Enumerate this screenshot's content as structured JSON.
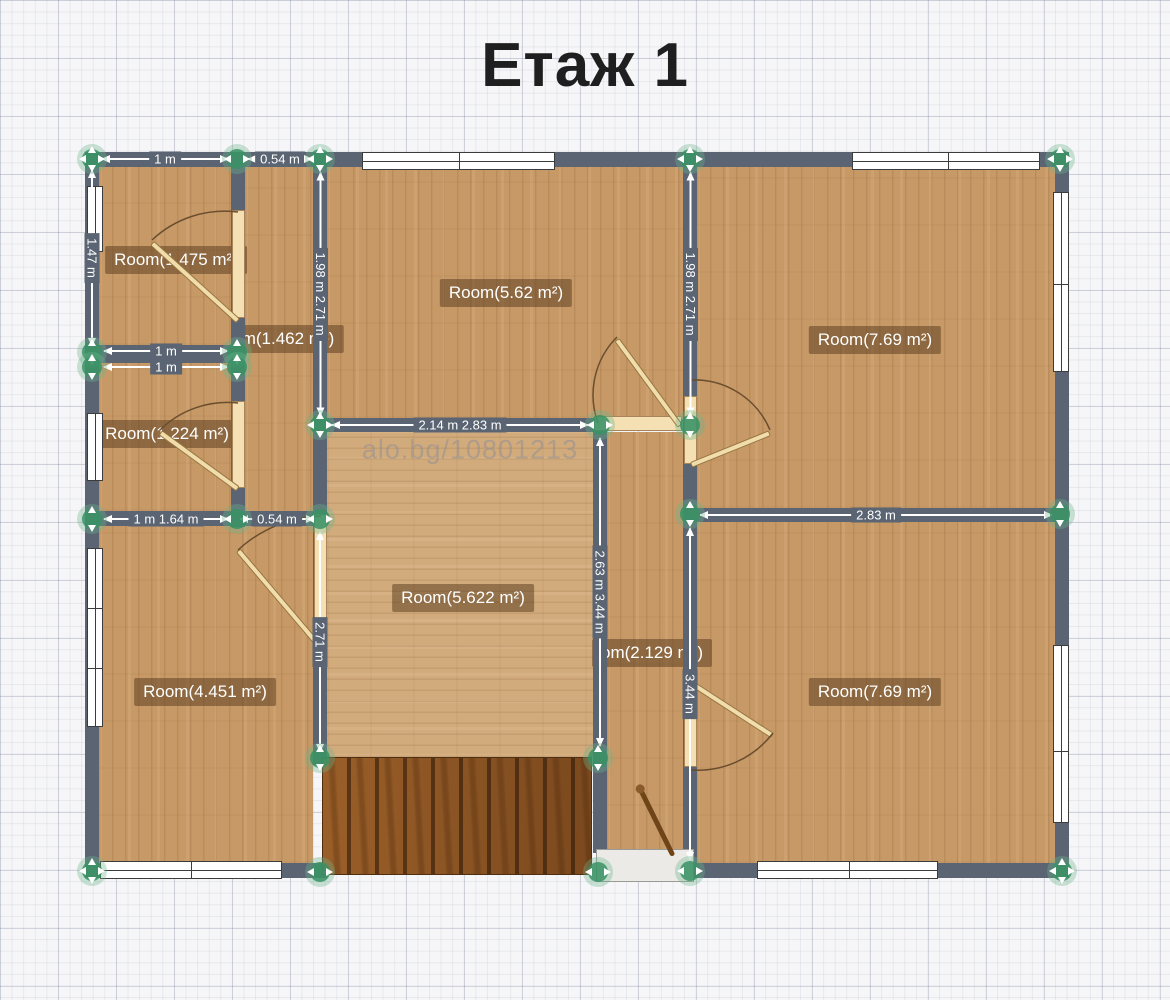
{
  "title": "Етаж 1",
  "watermark": {
    "text": "alo.bg/10801213",
    "cx": 470,
    "cy": 450
  },
  "colors": {
    "wall": "#5a6472",
    "handle_green": "#389265",
    "wood_light": "#c79967",
    "wood_center": "#d2ab7d",
    "stairs_brown": "#8c5322",
    "door_beige": "#f4e0b2",
    "label_bg": "rgba(90,60,28,0.52)",
    "grid_bg": "#f6f6f8"
  },
  "floors": [
    {
      "id": "room-1475-floor",
      "x": 99,
      "y": 167,
      "w": 132,
      "h": 178,
      "grain": "v"
    },
    {
      "id": "room-1462-floor",
      "x": 245,
      "y": 167,
      "w": 68,
      "h": 351,
      "grain": "v"
    },
    {
      "id": "room-1224-floor",
      "x": 99,
      "y": 363,
      "w": 132,
      "h": 148,
      "grain": "v"
    },
    {
      "id": "room-562-floor",
      "x": 327,
      "y": 167,
      "w": 356,
      "h": 251,
      "grain": "v"
    },
    {
      "id": "room-769-top-floor",
      "x": 697,
      "y": 167,
      "w": 358,
      "h": 341,
      "grain": "v"
    },
    {
      "id": "room-5622-floor",
      "x": 327,
      "y": 432,
      "w": 266,
      "h": 325,
      "grain": "h"
    },
    {
      "id": "hallway-floor",
      "x": 607,
      "y": 432,
      "w": 76,
      "h": 421,
      "grain": "v"
    },
    {
      "id": "room-4451-floor",
      "x": 99,
      "y": 526,
      "w": 214,
      "h": 337,
      "grain": "v"
    },
    {
      "id": "room-769-bottom-floor",
      "x": 697,
      "y": 522,
      "w": 358,
      "h": 341,
      "grain": "v"
    }
  ],
  "room_labels": [
    {
      "id": "room-1475-label",
      "text": "Room(1.475 m²)",
      "cx": 176,
      "cy": 260
    },
    {
      "id": "room-1462-label",
      "text": "m(1.462 m²)",
      "cx": 288,
      "cy": 339
    },
    {
      "id": "room-562-label",
      "text": "Room(5.62 m²)",
      "cx": 506,
      "cy": 293
    },
    {
      "id": "room-769-top-label",
      "text": "Room(7.69 m²)",
      "cx": 875,
      "cy": 340
    },
    {
      "id": "room-1224-label",
      "text": "Room(1.224 m²)",
      "cx": 167,
      "cy": 434
    },
    {
      "id": "room-5622-label",
      "text": "Room(5.622 m²)",
      "cx": 463,
      "cy": 598
    },
    {
      "id": "hallway-label",
      "text": "om(2.129 m²)",
      "cx": 652,
      "cy": 653
    },
    {
      "id": "room-4451-label",
      "text": "Room(4.451 m²)",
      "cx": 205,
      "cy": 692
    },
    {
      "id": "room-769-bottom-label",
      "text": "Room(7.69 m²)",
      "cx": 875,
      "cy": 692
    }
  ],
  "walls": [
    {
      "x": 85,
      "y": 152,
      "w": 984,
      "h": 15
    },
    {
      "x": 85,
      "y": 152,
      "w": 14,
      "h": 726
    },
    {
      "x": 1055,
      "y": 152,
      "w": 14,
      "h": 726
    },
    {
      "x": 85,
      "y": 863,
      "w": 242,
      "h": 15
    },
    {
      "x": 683,
      "y": 863,
      "w": 386,
      "h": 15
    },
    {
      "x": 231,
      "y": 152,
      "w": 14,
      "h": 375
    },
    {
      "x": 313,
      "y": 152,
      "w": 14,
      "h": 613
    },
    {
      "x": 593,
      "y": 425,
      "w": 14,
      "h": 428
    },
    {
      "x": 683,
      "y": 152,
      "w": 14,
      "h": 711
    },
    {
      "x": 85,
      "y": 345,
      "w": 160,
      "h": 18
    },
    {
      "x": 85,
      "y": 511,
      "w": 242,
      "h": 15
    },
    {
      "x": 313,
      "y": 418,
      "w": 294,
      "h": 14
    },
    {
      "x": 683,
      "y": 508,
      "w": 386,
      "h": 14
    }
  ],
  "windows": [
    {
      "x": 362,
      "y": 152,
      "w": 193,
      "h": 18,
      "o": "h",
      "divs": [
        96
      ]
    },
    {
      "x": 852,
      "y": 152,
      "w": 188,
      "h": 18,
      "o": "h",
      "divs": [
        95
      ]
    },
    {
      "x": 87,
      "y": 186,
      "w": 16,
      "h": 66,
      "o": "v",
      "divs": []
    },
    {
      "x": 87,
      "y": 413,
      "w": 16,
      "h": 68,
      "o": "v",
      "divs": []
    },
    {
      "x": 87,
      "y": 548,
      "w": 16,
      "h": 179,
      "o": "v",
      "divs": [
        59,
        119
      ]
    },
    {
      "x": 100,
      "y": 861,
      "w": 182,
      "h": 18,
      "o": "h",
      "divs": [
        90
      ]
    },
    {
      "x": 757,
      "y": 861,
      "w": 181,
      "h": 18,
      "o": "h",
      "divs": [
        91
      ]
    },
    {
      "x": 1053,
      "y": 192,
      "w": 16,
      "h": 180,
      "o": "v",
      "divs": [
        91
      ]
    },
    {
      "x": 1053,
      "y": 645,
      "w": 16,
      "h": 178,
      "o": "v",
      "divs": [
        105
      ]
    }
  ],
  "dimensions": [
    {
      "label": "1 m",
      "o": "h",
      "x": 102,
      "y": 159,
      "len": 126
    },
    {
      "label": "0.54 m",
      "o": "h",
      "x": 248,
      "y": 159,
      "len": 64
    },
    {
      "label": "1 m",
      "o": "h",
      "x": 104,
      "y": 351,
      "len": 124
    },
    {
      "label": "1 m",
      "o": "h",
      "x": 104,
      "y": 367,
      "len": 124
    },
    {
      "label": "1 m  1.64 m",
      "o": "h",
      "x": 104,
      "y": 519,
      "len": 124
    },
    {
      "label": "0.54 m",
      "o": "h",
      "x": 240,
      "y": 519,
      "len": 74
    },
    {
      "label": "2.14 m 2.83 m",
      "o": "h",
      "x": 332,
      "y": 425,
      "len": 256
    },
    {
      "label": "2.83 m",
      "o": "h",
      "x": 700,
      "y": 515,
      "len": 352
    },
    {
      "label": "1.47 m",
      "o": "v",
      "x": 92,
      "y": 170,
      "len": 176
    },
    {
      "label": "1.98 m 2.71 m",
      "o": "v",
      "x": 320,
      "y": 172,
      "len": 243
    },
    {
      "label": "1.98 m 2.71 m",
      "o": "v",
      "x": 690,
      "y": 172,
      "len": 243
    },
    {
      "label": "2.71 m",
      "o": "v",
      "x": 320,
      "y": 532,
      "len": 220
    },
    {
      "label": "2.63 m 3.44 m",
      "o": "v",
      "x": 600,
      "y": 438,
      "len": 308
    },
    {
      "label": "3.44 m",
      "o": "v",
      "x": 690,
      "y": 528,
      "len": 332
    }
  ],
  "handles": [
    {
      "x": 92,
      "y": 159,
      "dir": "hv"
    },
    {
      "x": 237,
      "y": 159,
      "dir": "h"
    },
    {
      "x": 320,
      "y": 159,
      "dir": "hv"
    },
    {
      "x": 690,
      "y": 159,
      "dir": "hv"
    },
    {
      "x": 1060,
      "y": 159,
      "dir": "hv"
    },
    {
      "x": 92,
      "y": 352,
      "dir": "v"
    },
    {
      "x": 92,
      "y": 367,
      "dir": "v"
    },
    {
      "x": 92,
      "y": 519,
      "dir": "v"
    },
    {
      "x": 92,
      "y": 871,
      "dir": "hv"
    },
    {
      "x": 237,
      "y": 352,
      "dir": "v"
    },
    {
      "x": 237,
      "y": 367,
      "dir": "v"
    },
    {
      "x": 237,
      "y": 519,
      "dir": "h"
    },
    {
      "x": 320,
      "y": 425,
      "dir": "hv"
    },
    {
      "x": 320,
      "y": 519,
      "dir": "h"
    },
    {
      "x": 320,
      "y": 758,
      "dir": "v"
    },
    {
      "x": 320,
      "y": 872,
      "dir": "h"
    },
    {
      "x": 600,
      "y": 425,
      "dir": "h"
    },
    {
      "x": 598,
      "y": 758,
      "dir": "v"
    },
    {
      "x": 598,
      "y": 872,
      "dir": "h"
    },
    {
      "x": 690,
      "y": 425,
      "dir": "v"
    },
    {
      "x": 690,
      "y": 514,
      "dir": "v"
    },
    {
      "x": 690,
      "y": 871,
      "dir": "h"
    },
    {
      "x": 1060,
      "y": 514,
      "dir": "v"
    },
    {
      "x": 1062,
      "y": 871,
      "dir": "hv"
    }
  ],
  "door_openings": [
    {
      "x": 232,
      "y": 210,
      "w": 13,
      "h": 108
    },
    {
      "x": 232,
      "y": 401,
      "w": 13,
      "h": 87
    },
    {
      "x": 314,
      "y": 514,
      "w": 13,
      "h": 136
    },
    {
      "x": 594,
      "y": 416,
      "w": 88,
      "h": 15
    },
    {
      "x": 684,
      "y": 396,
      "w": 13,
      "h": 68
    },
    {
      "x": 684,
      "y": 674,
      "w": 13,
      "h": 93
    }
  ],
  "door_leaves": [
    {
      "x": 238,
      "y": 318,
      "len": 116,
      "ang": -137.8
    },
    {
      "x": 238,
      "y": 486,
      "len": 96,
      "ang": -144
    },
    {
      "x": 321,
      "y": 645,
      "len": 128,
      "ang": -130.3
    },
    {
      "x": 680,
      "y": 423,
      "len": 107,
      "ang": -126.2
    },
    {
      "x": 691,
      "y": 462,
      "len": 85,
      "ang": -22
    },
    {
      "x": 691,
      "y": 680,
      "len": 97,
      "ang": 32.9
    }
  ],
  "door_arcs": [
    "M238,212 A106,106 0 0 0 152,240",
    "M238,403 A96,96 0 0 0 160,430",
    "M321,516 A129,129 0 0 0 238,550",
    "M598,423 A82,82 0 0 1 617,337",
    "M691,380 A82,82 0 0 1 770,430",
    "M691,770 A95,95 0 0 0 773,733"
  ],
  "stairs": {
    "x": 322,
    "y": 757,
    "w": 270,
    "h": 118
  },
  "entrance_mat": {
    "x": 596,
    "y": 849,
    "w": 98,
    "h": 33
  },
  "entrance_rod": {
    "x": 640,
    "y": 786,
    "len": 75,
    "ang": 63.8
  }
}
